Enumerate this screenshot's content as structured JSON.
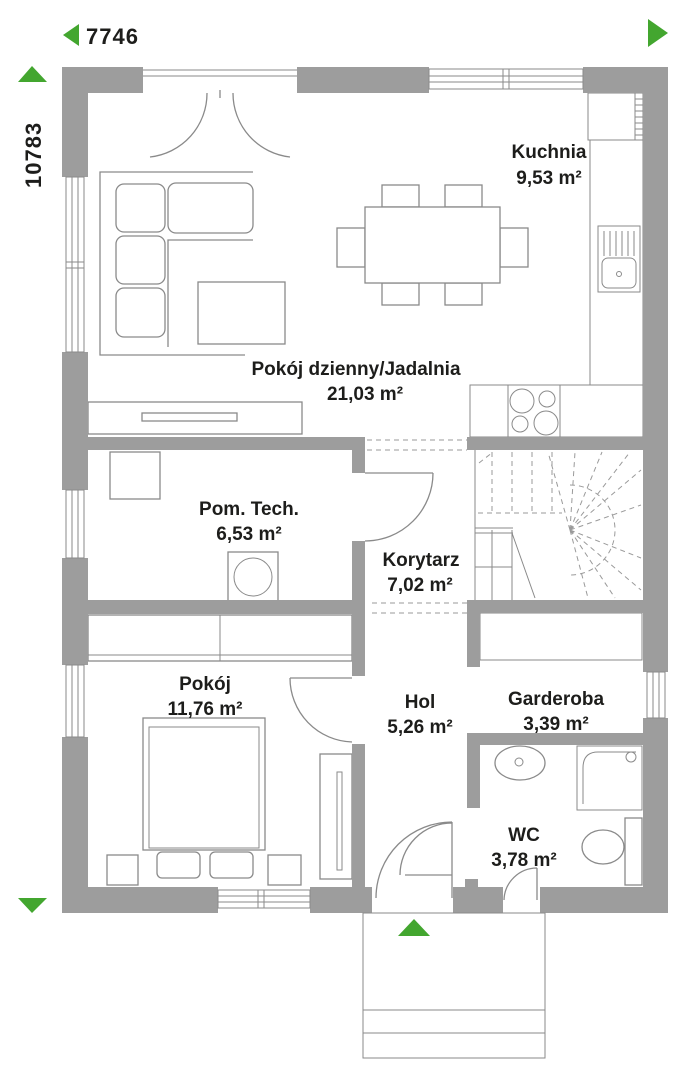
{
  "title": "Parter - rzut kondygnacji",
  "dimension_labels": {
    "width": "7746",
    "height": "10783"
  },
  "rooms": [
    {
      "name": "Kuchnia",
      "area": "9,53 m²"
    },
    {
      "name": "Pokój dzienny/Jadalnia",
      "area": "21,03 m²"
    },
    {
      "name": "Pom. Tech.",
      "area": "6,53 m²"
    },
    {
      "name": "Korytarz",
      "area": "7,02 m²"
    },
    {
      "name": "Pokój",
      "area": "11,76 m²"
    },
    {
      "name": "Hol",
      "area": "5,26 m²"
    },
    {
      "name": "Garderoba",
      "area": "3,39 m²"
    },
    {
      "name": "WC",
      "area": "3,78 m²"
    }
  ],
  "colors": {
    "wall": "#9d9d9d",
    "green": "#43a62f",
    "line": "#8a8a8a",
    "text": "#1d1d1b"
  }
}
